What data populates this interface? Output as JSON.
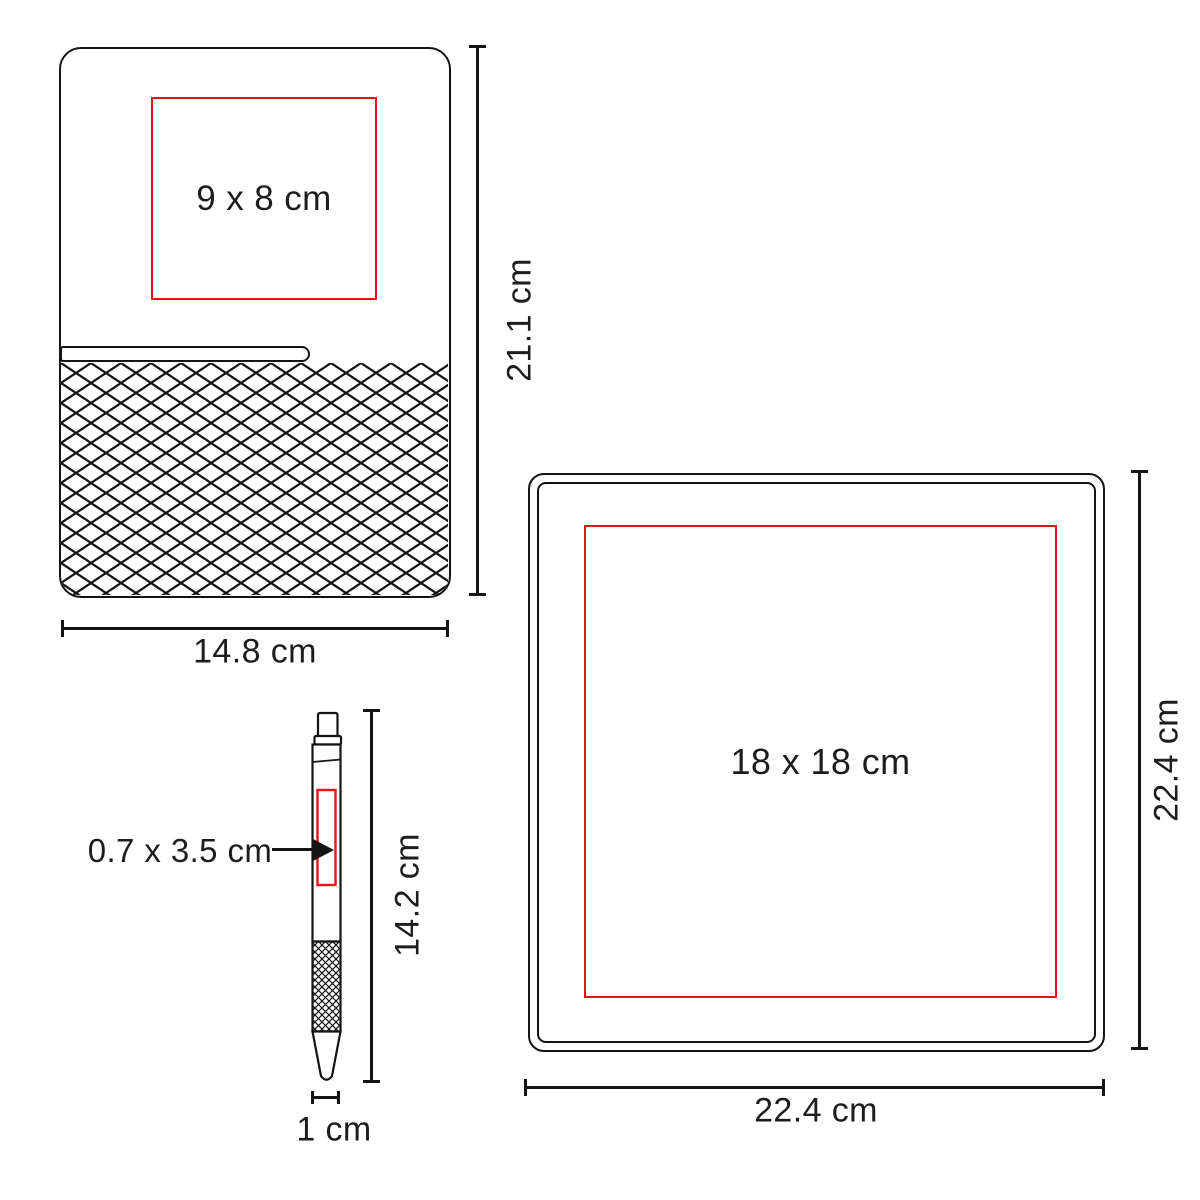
{
  "colors": {
    "line": "#141414",
    "text": "#1d1d1d",
    "print_area_red": "#e41418",
    "background": "#ffffff"
  },
  "items": {
    "notebook": {
      "print_area_label": "9 x 8 cm",
      "height_label": "21.1 cm",
      "width_label": "14.8 cm"
    },
    "pen": {
      "print_area_label": "0.7 x 3.5 cm",
      "height_label": "14.2 cm",
      "width_label": "1 cm"
    },
    "mousepad": {
      "print_area_label": "18 x 18 cm",
      "height_label": "22.4 cm",
      "width_label": "22.4 cm"
    }
  }
}
